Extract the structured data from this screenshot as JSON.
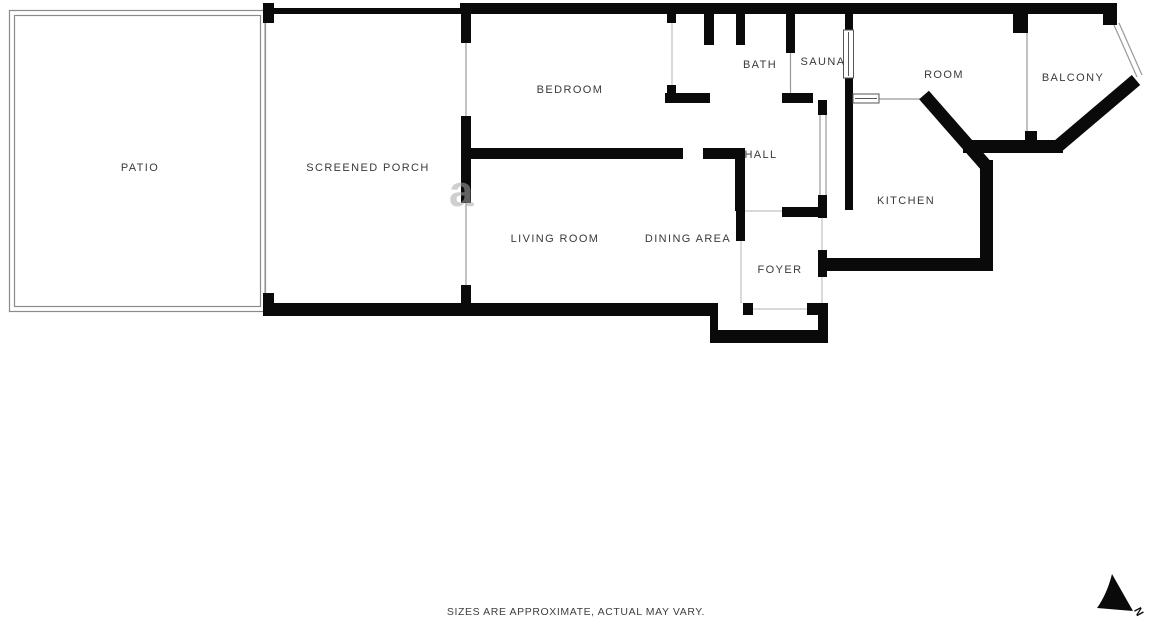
{
  "floor_plan": {
    "rooms": [
      {
        "id": "patio",
        "label": "PATIO"
      },
      {
        "id": "screened-porch",
        "label": "SCREENED PORCH"
      },
      {
        "id": "bedroom",
        "label": "BEDROOM"
      },
      {
        "id": "bath",
        "label": "BATH"
      },
      {
        "id": "sauna",
        "label": "SAUNA"
      },
      {
        "id": "room",
        "label": "ROOM"
      },
      {
        "id": "balcony",
        "label": "BALCONY"
      },
      {
        "id": "hall",
        "label": "HALL"
      },
      {
        "id": "kitchen",
        "label": "KITCHEN"
      },
      {
        "id": "living-room",
        "label": "LIVING ROOM"
      },
      {
        "id": "dining-area",
        "label": "DINING AREA"
      },
      {
        "id": "foyer",
        "label": "FOYER"
      }
    ],
    "disclaimer": "SIZES ARE APPROXIMATE, ACTUAL MAY VARY.",
    "compass": {
      "label": "N"
    },
    "watermark": "a",
    "colors": {
      "wall": "#0a0a0a",
      "thin_line": "#999999",
      "door_line": "#c2c2c2",
      "patio_line": "#8a8a8a",
      "label_text": "#3a3a3a",
      "background": "#ffffff"
    }
  }
}
